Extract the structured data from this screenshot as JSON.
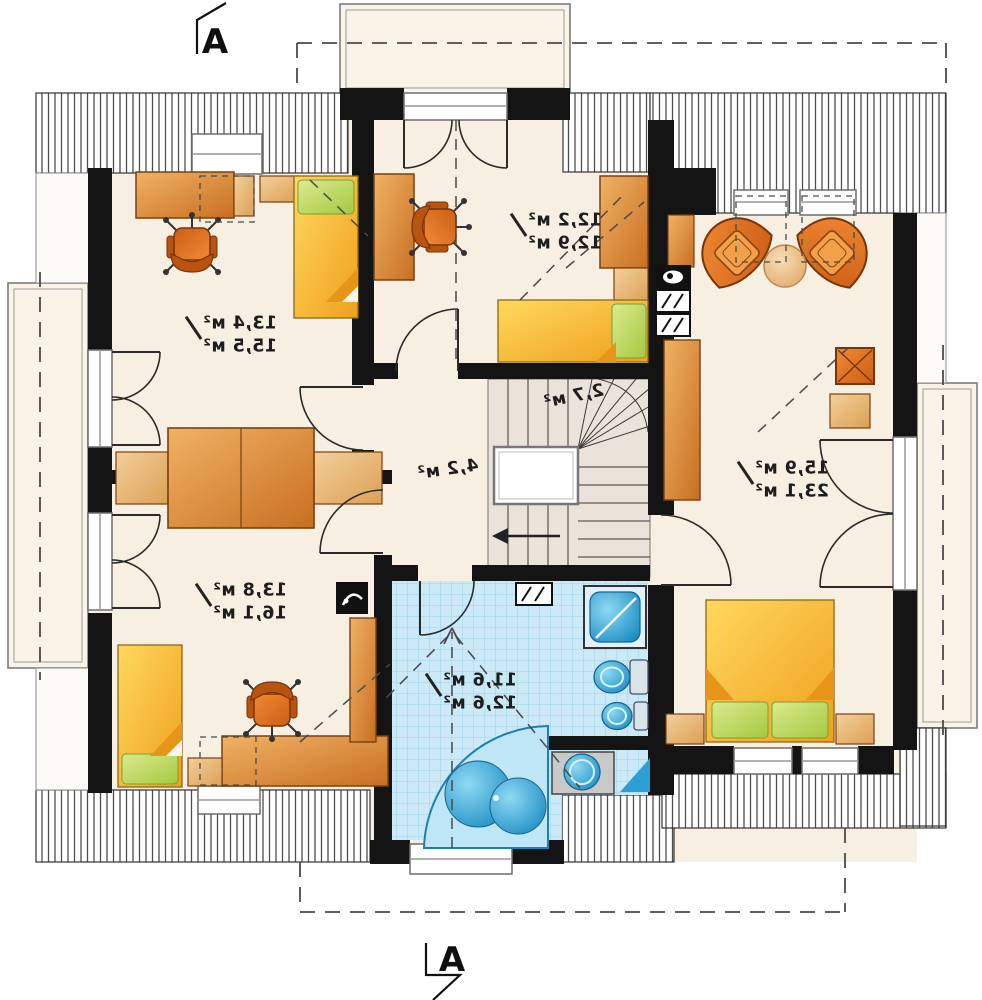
{
  "section_markers": {
    "top": "A",
    "bottom": "A"
  },
  "rooms": {
    "top_left": {
      "area_primary": "13,4 м²",
      "area_secondary": "15,5 м²"
    },
    "top_middle": {
      "area_primary": "12,2 м²",
      "area_secondary": "12,9 м²"
    },
    "right": {
      "area_primary": "15,9 м²",
      "area_secondary": "23,1 м²"
    },
    "bottom_left": {
      "area_primary": "13,8 м²",
      "area_secondary": "16,1 м²"
    },
    "bathroom": {
      "area_primary": "11,6 м²",
      "area_secondary": "12,6 м²"
    },
    "hall": {
      "area": "4,2 м²"
    },
    "staircase": {
      "area": "2,7 м²"
    }
  },
  "icons": {
    "washing_machine": "hatched-box-icon",
    "kitchenette_sink": "black-box-pot-icon",
    "kitchenette_hob": "hatched-box-icon",
    "tv_unit": "black-box-icon",
    "stair_direction": "arrow-left-icon",
    "ceiling_slope": "dashed-arrow-icon"
  },
  "colors": {
    "floor": "#f7efe2",
    "wall": "#141414",
    "wood": "#d98b43",
    "bed": "#f7bf35",
    "pillow": "#bcd96a",
    "tile": "#cbe9f6",
    "fixture_blue": "#2ba3d8",
    "stairs": "#eae3da"
  }
}
